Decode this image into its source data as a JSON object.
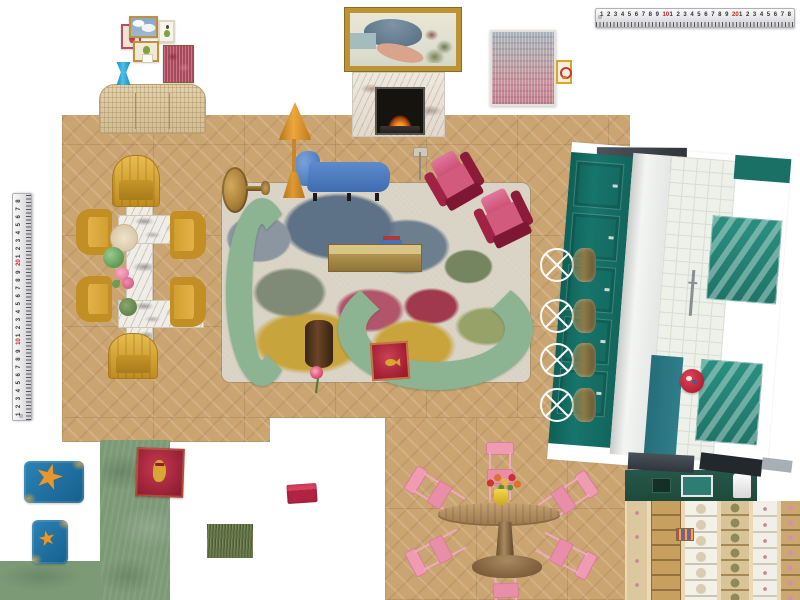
{
  "canvas": {
    "type": "interior-design-moodboard",
    "background": "#ffffff"
  },
  "rulers": {
    "sequence": [
      "1",
      "2",
      "3",
      "4",
      "5",
      "6",
      "7",
      "8",
      "9",
      "10",
      "1",
      "2",
      "3",
      "4",
      "5",
      "6",
      "7",
      "8",
      "9",
      "20",
      "1",
      "2",
      "3",
      "4",
      "5",
      "6",
      "7",
      "8"
    ],
    "red_values": [
      "10",
      "20"
    ]
  },
  "counts": {
    "gallery_frames": 5,
    "yellow_armchairs": 6,
    "magenta_armchairs": 2,
    "green_curved_sofas": 2,
    "bar_stools": 4,
    "pink_dining_chairs": 6
  },
  "palette": {
    "wood_floor": "#cba571",
    "rug_base": "#d8d3c4",
    "sofa_green": "#8cb493",
    "chaise_blue": "#4d82c6",
    "lamp_orange": "#dc9834",
    "armchair_yellow": "#d8a430",
    "magenta_armchair": "#c23058",
    "kitchen_teal": "#17756b",
    "pink_chair": "#ec9db3",
    "pillow_crimson": "#b5273b",
    "pillow_blue": "#2173a6",
    "starfish_orange": "#e8962e",
    "swatch_green": "#7d9a77",
    "brass": "#ad9150",
    "marble_white": "#f0ede6",
    "ruler_red": "#cc2222"
  },
  "icons": {
    "starfish": "★"
  },
  "objects": [
    "horizontal-ruler",
    "vertical-ruler",
    "gallery-frame-figure",
    "gallery-frame-sky-painting",
    "gallery-frame-pear-bird",
    "gallery-frame-pear-pedestal",
    "gallery-frame-red-abstract",
    "blue-side-stool",
    "rattan-sideboard",
    "landscape-painting",
    "marble-fireplace",
    "pink-mosaic-artwork",
    "mini-framed-art",
    "yellow-armchair",
    "marble-dining-table",
    "round-plate",
    "green-bowl",
    "pink-flowers",
    "olive-dish",
    "abstract-area-rug",
    "brass-pedestal-table",
    "orange-floor-lamp",
    "blue-chaise-lounge",
    "green-curved-sofa",
    "brass-coffee-table",
    "stacked-books",
    "wood-stump-side-table",
    "goldfish-pillow",
    "pink-rose",
    "magenta-armchair",
    "reading-lamp",
    "kitchen-photo",
    "bar-stool",
    "red-round-plate",
    "starfish-pillow-large",
    "starfish-pillow-small",
    "green-runner-rug",
    "tiger-pillow",
    "green-fabric-swatch",
    "grass-fringe-swatch",
    "red-folded-swatch",
    "pink-dining-chair",
    "wood-pedestal-table",
    "flower-bouquet",
    "yellow-vase",
    "kitchen-plan-render",
    "wood-floor-swatch"
  ]
}
